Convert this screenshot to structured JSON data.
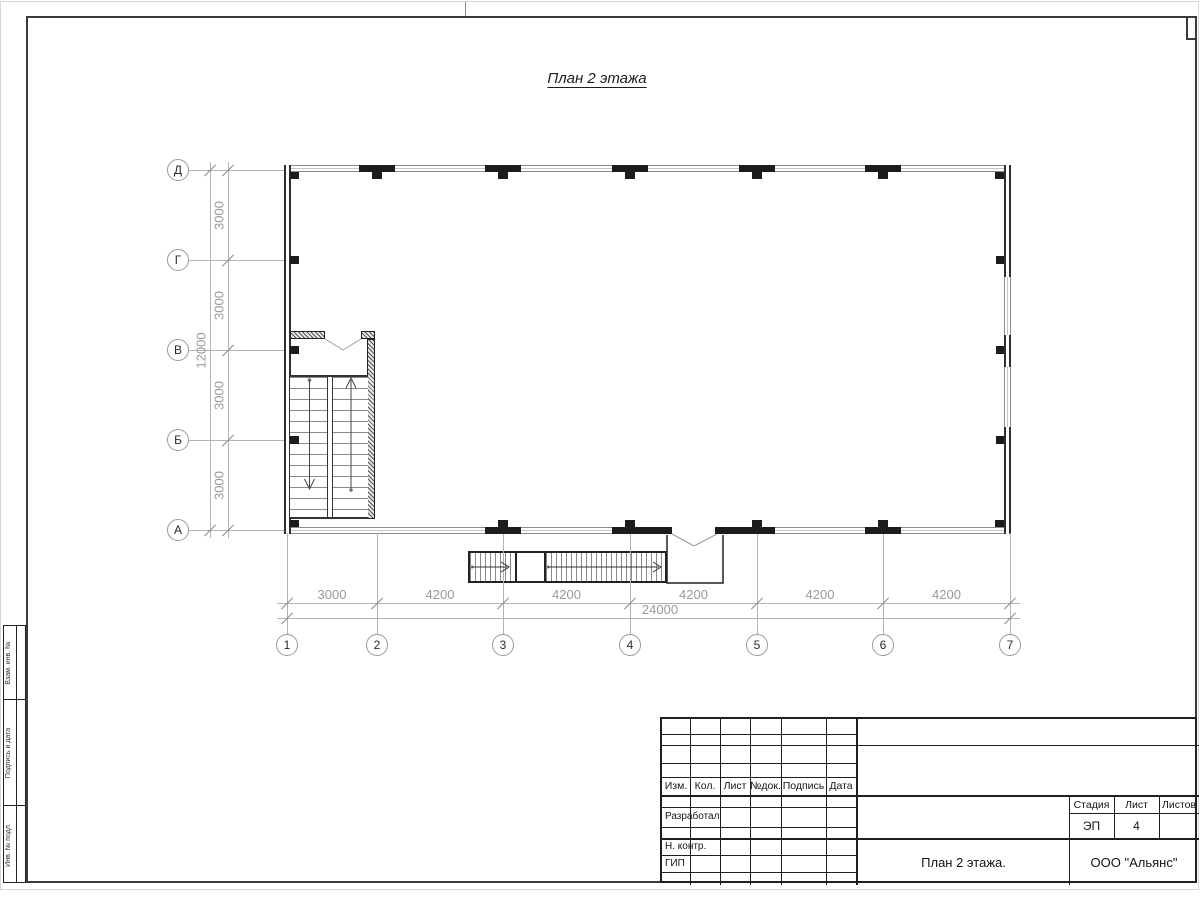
{
  "sheet": {
    "title": "План 2 этажа",
    "axis_rows": [
      "Д",
      "Г",
      "В",
      "Б",
      "А"
    ],
    "axis_cols": [
      "1",
      "2",
      "3",
      "4",
      "5",
      "6",
      "7"
    ],
    "dims_h": [
      "3000",
      "4200",
      "4200",
      "4200",
      "4200",
      "4200"
    ],
    "dims_h_total": "24000",
    "dims_v": [
      "3000",
      "3000",
      "3000",
      "3000"
    ],
    "dims_v_total": "12000"
  },
  "titleblock": {
    "header_cols": [
      "Изм.",
      "Кол.",
      "Лист",
      "№док.",
      "Подпись",
      "Дата"
    ],
    "roles": [
      "Разработал",
      "Н. контр.",
      "ГИП"
    ],
    "stage_label": "Стадия",
    "sheet_label": "Лист",
    "sheets_label": "Листов",
    "stage_value": "ЭП",
    "sheet_value": "4",
    "sheets_value": "",
    "drawing_title": "План 2 этажа.",
    "company": "ООО \"Альянс\""
  },
  "side_stamp": [
    "Взам. инв. №",
    "Подпись и дата",
    "Инв. № подл."
  ],
  "colors": {
    "drawing_dark": "#1c1c1c",
    "grid_gray": "#b3b3b3",
    "dim_text_gray": "#9a9a9a",
    "frame_dark": "#3a3a3a"
  }
}
